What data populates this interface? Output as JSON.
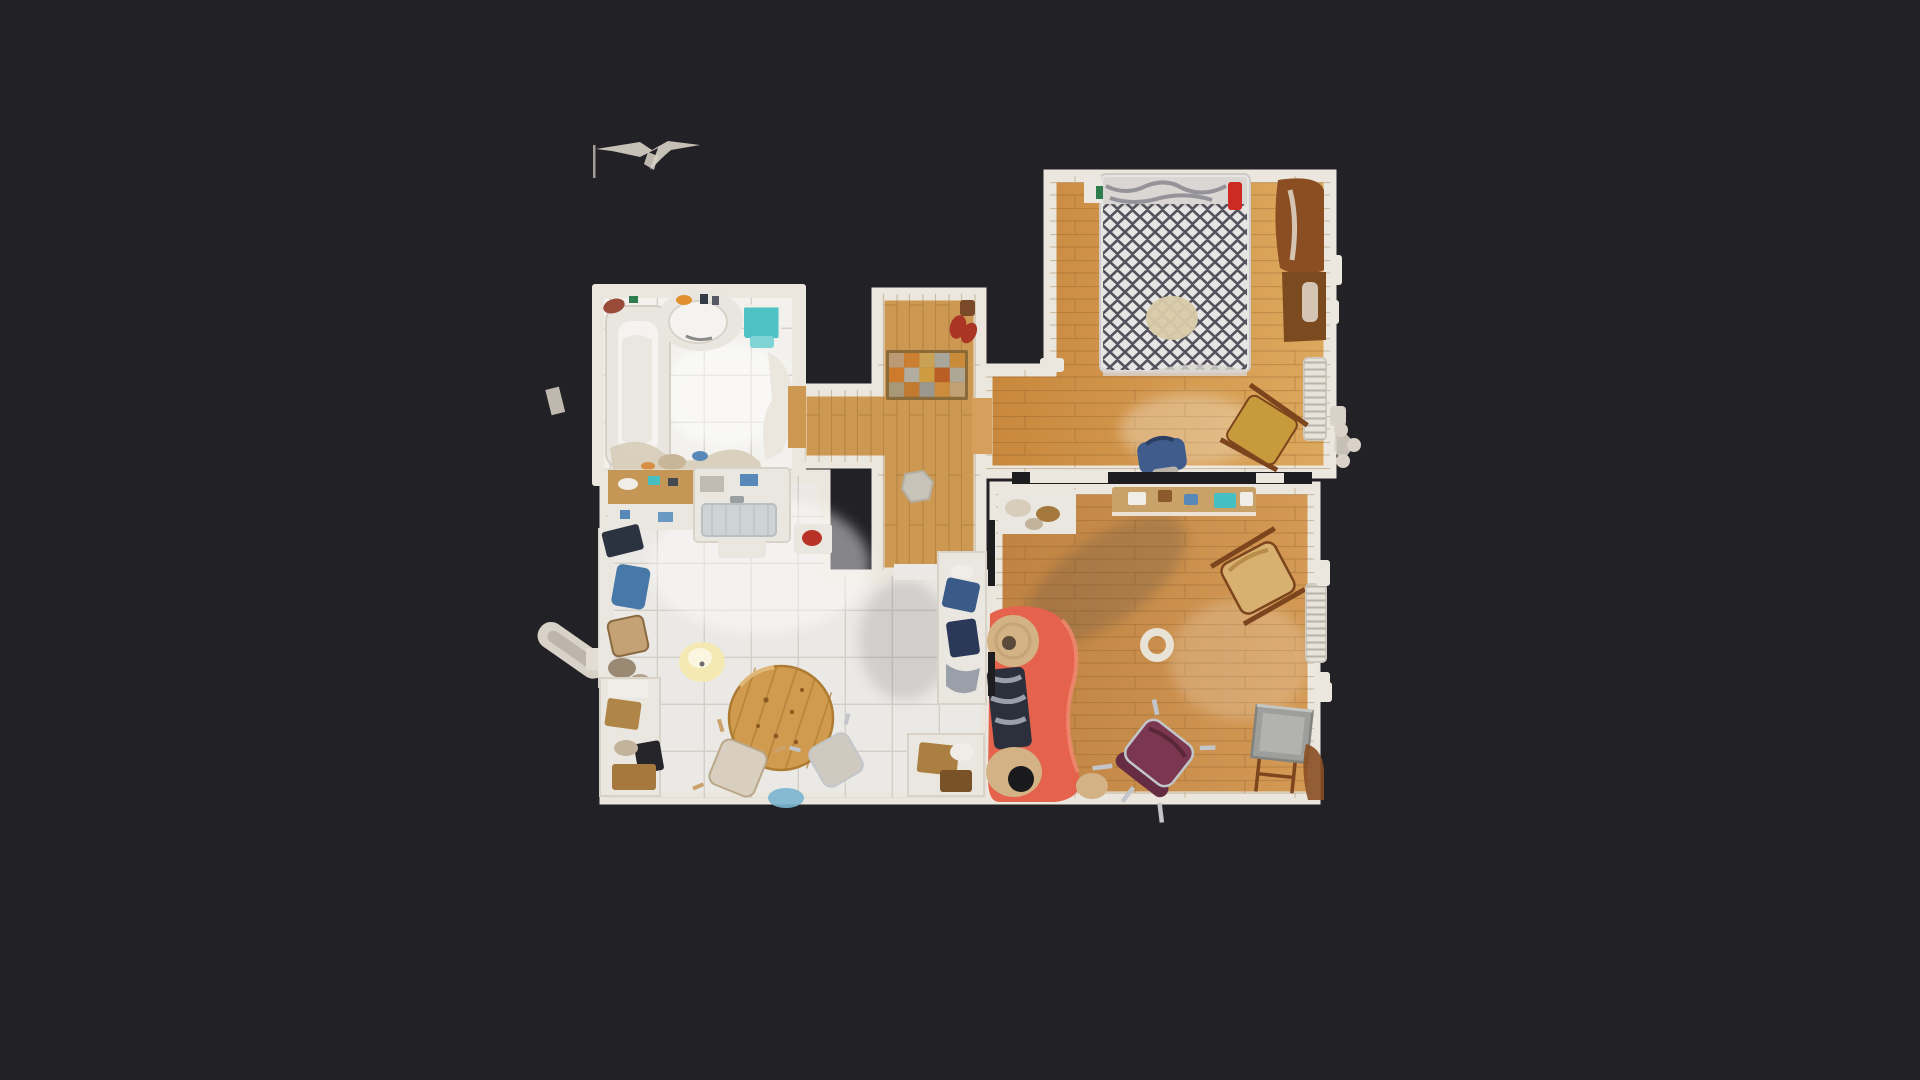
{
  "scene": {
    "background": "#222226"
  },
  "palette": {
    "wall": "#ece7de",
    "wall_dark": "#1d1d20",
    "bath_floor": "#f2f1ee",
    "bath_fixture": "#e9e5df",
    "tub_inner": "#f5f3f0",
    "kitchen_floor": "#ebe9e6",
    "corridor_wood": "#cd9851",
    "hall_wood": "#d6a05c",
    "bedroom_wood_dark": "#c8873d",
    "bedroom_wood_light": "#dda95e",
    "living_wood_dark": "#bf8242",
    "living_wood_light": "#d49a55",
    "plank_line": "#8a5e28",
    "tile_line": "#cfc9c1",
    "table_wood": "#d09b4f",
    "table_line": "#ad7c32",
    "counter_white": "#eae7e1",
    "counter_wood": "#c59757",
    "sink_basin": "#ccd4d6",
    "teal": "#46bfc2",
    "teal_light": "#7fd4d6",
    "appliance_navy": "#2c3340",
    "chair_blue": "#4878a8",
    "chair_tan": "#c5a276",
    "cabinet_brown": "#aa7f41",
    "box_brown": "#b08648",
    "dark_item": "#26262a",
    "lamp_glow": "#f4e8b0",
    "bed_base": "#e7e5e3",
    "duvet_pattern": "#53535d",
    "pillow": "#d9d6d3",
    "pillow_streak": "#82828c",
    "bed_towel": "#d8cba9",
    "red_accent": "#cc2a22",
    "green_accent": "#2e7d4f",
    "wardrobe_brown": "#8a4e22",
    "rug_brown": "#7c4a1f",
    "radiator": "#e7e3db",
    "radiator_rib": "#b9b3a8",
    "mustard_chair": "#c79b3c",
    "chair_frame_brown": "#7c451d",
    "bag_blue": "#3f5c8c",
    "sofa_red": "#e5634c",
    "sofa_beige": "#d3b285",
    "clutter_navy": "#2b303c",
    "clutter_silver": "#9aa0aa",
    "purple_chair": "#7c3750",
    "purple_chair_dark": "#662c42",
    "frame_silver": "#c2c6ca",
    "tan_chair": "#d8b070",
    "gray_box": "#9e9e9c",
    "gray_box_top": "#b2b2af",
    "shelf_wood": "#c9a26a",
    "stone": "#c8c3b8",
    "shoes_red": "#ab3524",
    "artifact_white": "#d9d2c8",
    "glare": "#ffffff",
    "shadow": "#3a3a40",
    "clutter_beige": "#d8cdbb",
    "clutter_brown": "#a5793d",
    "clutter_blue": "#5888b8",
    "clutter_white": "#f0ede8"
  },
  "doormat": {
    "border": "#8a6a38",
    "squares": [
      "#b99a74",
      "#cc7e31",
      "#c9a255",
      "#a8a59b",
      "#c98a3a",
      "#cd7a2c",
      "#b3ada0",
      "#cd9c40",
      "#bb5e26",
      "#aea795",
      "#a99878",
      "#c27a31",
      "#9b9890",
      "#cd8c3c",
      "#c0a173"
    ]
  }
}
